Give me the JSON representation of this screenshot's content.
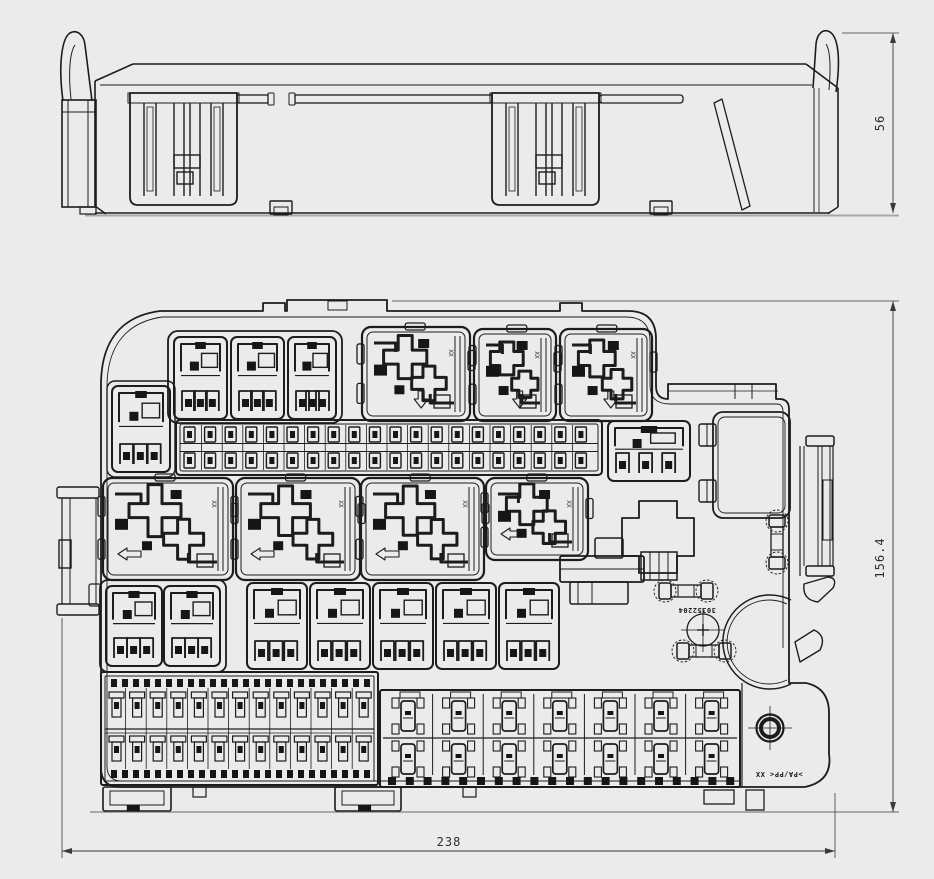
{
  "dimensions": {
    "side_view_height": "56",
    "plan_view_height": "156.4",
    "plan_view_width": "238"
  },
  "annotations": {
    "part_number": "30352204",
    "material_mark": ">PA/PP<  XX",
    "socket_mark": "XX"
  },
  "colors": {
    "background": "#ebebeb",
    "line": "#1c1c1c",
    "fill_dark": "#161616",
    "dim_line": "#3a3a3a",
    "extension_gray": "#a8a8a8"
  }
}
